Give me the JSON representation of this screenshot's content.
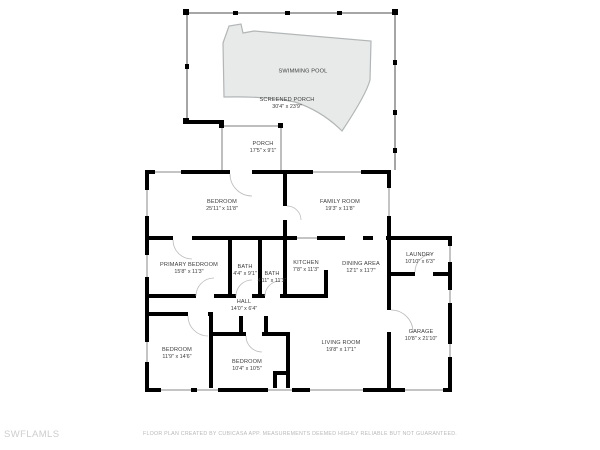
{
  "watermark": {
    "text": "SWFLAMLS"
  },
  "footer": {
    "disclaimer": "FLOOR PLAN CREATED BY CUBICASA APP. MEASUREMENTS DEEMED HIGHLY RELIABLE BUT NOT GUARANTEED."
  },
  "colors": {
    "wall": "#000000",
    "pool_fill": "#e8eaea",
    "pool_outline": "#b2b6b6",
    "screen_wall": "#a6a6a6",
    "label_text": "#3d3d3d",
    "footer_text": "#b9b9b9",
    "watermark_text": "#cdcdcd"
  },
  "rooms": [
    {
      "id": "swimming-pool",
      "name": "SWIMMING POOL",
      "dims": ""
    },
    {
      "id": "screened-porch",
      "name": "SCREENED PORCH",
      "dims": "30'4\" x 23'9\""
    },
    {
      "id": "porch",
      "name": "PORCH",
      "dims": "17'5\" x 9'1\""
    },
    {
      "id": "bedroom-top",
      "name": "BEDROOM",
      "dims": "25'11\" x 11'8\""
    },
    {
      "id": "family-room",
      "name": "FAMILY ROOM",
      "dims": "19'3\" x 11'8\""
    },
    {
      "id": "primary-bedroom",
      "name": "PRIMARY BEDROOM",
      "dims": "15'8\" x 11'3\""
    },
    {
      "id": "bath-1",
      "name": "BATH",
      "dims": "4'4\" x 9'1\""
    },
    {
      "id": "bath-2",
      "name": "BATH",
      "dims": "4'11\" x 11'3\""
    },
    {
      "id": "kitchen",
      "name": "KITCHEN",
      "dims": "7'8\" x 11'3\""
    },
    {
      "id": "dining-area",
      "name": "DINING AREA",
      "dims": "12'1\" x 11'7\""
    },
    {
      "id": "laundry",
      "name": "LAUNDRY",
      "dims": "10'10\" x 6'3\""
    },
    {
      "id": "hall",
      "name": "HALL",
      "dims": "14'0\" x 6'4\""
    },
    {
      "id": "bedroom-left",
      "name": "BEDROOM",
      "dims": "11'9\" x 14'6\""
    },
    {
      "id": "bedroom-middle",
      "name": "BEDROOM",
      "dims": "10'4\" x 10'5\""
    },
    {
      "id": "living-room",
      "name": "LIVING ROOM",
      "dims": "19'8\" x 17'1\""
    },
    {
      "id": "garage",
      "name": "GARAGE",
      "dims": "10'8\" x 21'10\""
    }
  ]
}
